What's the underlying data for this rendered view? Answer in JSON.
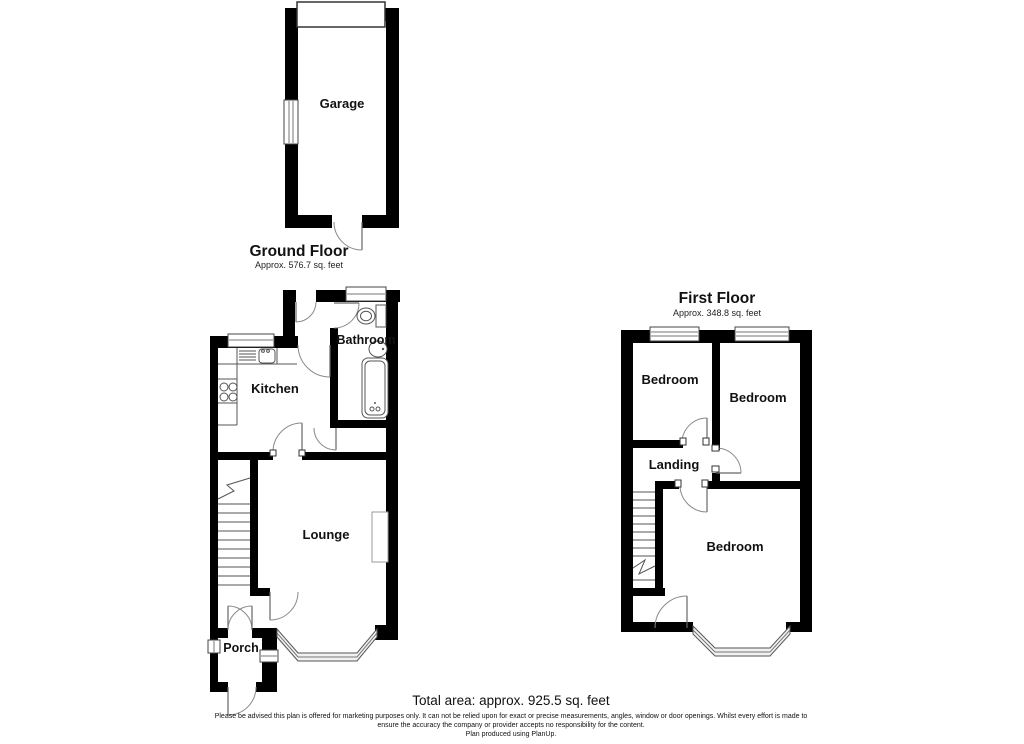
{
  "colors": {
    "wall": "#000000",
    "line": "#8a8a8a",
    "background": "#ffffff"
  },
  "garage": {
    "label": "Garage"
  },
  "ground_floor": {
    "title": "Ground Floor",
    "area": "Approx. 576.7 sq. feet",
    "kitchen": "Kitchen",
    "bathroom": "Bathroom",
    "lounge": "Lounge",
    "porch": "Porch"
  },
  "first_floor": {
    "title": "First Floor",
    "area": "Approx. 348.8 sq. feet",
    "bedroom_left": "Bedroom",
    "bedroom_right": "Bedroom",
    "bedroom_front": "Bedroom",
    "landing": "Landing"
  },
  "footer": {
    "total_area": "Total area: approx. 925.5 sq. feet",
    "disclaimer_line1": "Please be advised this plan is offered for marketing purposes only. It can not be relied upon for exact or precise measurements, angles, window or door openings. Whilst every effort is made to",
    "disclaimer_line2": "ensure the accuracy the company or provider accepts no responsibility for the content.",
    "credit": "Plan produced using PlanUp."
  }
}
